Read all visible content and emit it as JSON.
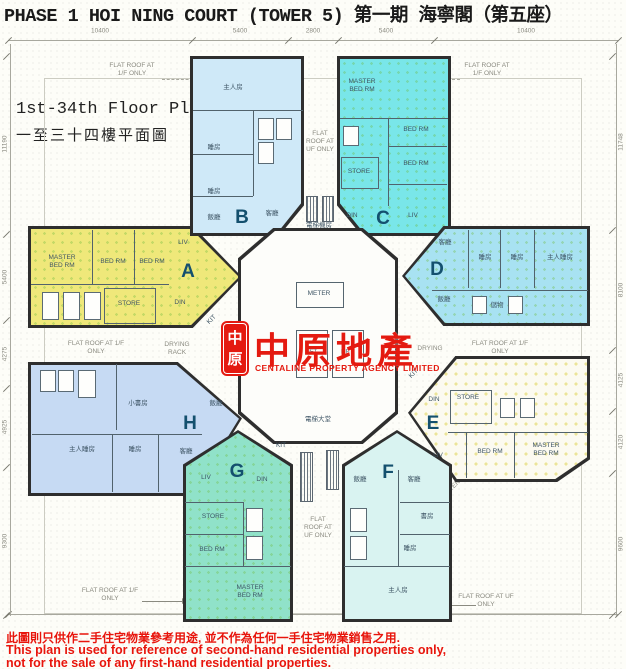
{
  "title": "PHASE 1 HOI NING COURT (TOWER 5) 第一期 海寧閣（第五座）",
  "floor_label": {
    "en": "1st-34th Floor Plan",
    "zh": "一至三十四樓平面圖"
  },
  "logo": {
    "seal_char1": "中",
    "seal_char2": "原",
    "name": "中原地產",
    "subtitle": "CENTALINE PROPERTY AGENCY LIMITED",
    "color": "#e41a10"
  },
  "disclaimer": {
    "zh": "此圖則只供作二手住宅物業參考用途, 並不作為任何一手住宅物業銷售之用.",
    "en1": "This plan is used for reference of second-hand residential properties only,",
    "en2": "not for the sale of any first-hand residential properties."
  },
  "dimensions": {
    "top": [
      "10400",
      "5400",
      "2800",
      "5400",
      "10400"
    ],
    "left": [
      "11190",
      "5400",
      "4275",
      "4925",
      "9300"
    ],
    "right": [
      "11748",
      "8100",
      "4125",
      "4120",
      "9600"
    ]
  },
  "annotations": {
    "flat_roof_1f": "FLAT ROOF AT 1/F ONLY",
    "flat_roof_uf": "FLAT ROOF AT UF ONLY",
    "drying_rack": "DRYING RACK",
    "drying": "DRYING",
    "planter": "PLANTER"
  },
  "core": {
    "meter": "METER",
    "lift": "LIFT",
    "lift_machine": "電梯機房",
    "lift_lobby": "電梯大堂"
  },
  "units": {
    "A": {
      "letter": "A",
      "color": "#efe87a",
      "rooms": [
        "MASTER BED RM",
        "BED RM",
        "BED RM",
        "STORE",
        "LIV",
        "DIN",
        "KIT"
      ]
    },
    "B": {
      "letter": "B",
      "color": "#cfe9f8",
      "rooms": [
        "主人房",
        "睡房",
        "睡房",
        "飯廳",
        "客廳"
      ]
    },
    "C": {
      "letter": "C",
      "color": "#79e6e9",
      "rooms": [
        "MASTER BED RM",
        "BED RM",
        "BED RM",
        "STORE",
        "DIN",
        "LIV"
      ]
    },
    "D": {
      "letter": "D",
      "color": "#a8e2f2",
      "rooms": [
        "客廳",
        "睡房",
        "睡房",
        "主人睡房",
        "飯廳",
        "儲物"
      ]
    },
    "E": {
      "letter": "E",
      "color": "#fcfaf0",
      "rooms": [
        "KIT",
        "STORE",
        "DIN",
        "LIV",
        "BED RM",
        "MASTER BED RM"
      ]
    },
    "F": {
      "letter": "F",
      "color": "#d9f3f1",
      "rooms": [
        "飯廳",
        "客廳",
        "書房",
        "睡房",
        "主人房"
      ]
    },
    "G": {
      "letter": "G",
      "color": "#90e2c9",
      "rooms": [
        "KIT",
        "DIN",
        "LIV",
        "STORE",
        "BED RM",
        "MASTER BED RM"
      ]
    },
    "H": {
      "letter": "H",
      "color": "#c6daf3",
      "rooms": [
        "小書房",
        "飯廳",
        "主人睡房",
        "睡房",
        "客廳"
      ]
    }
  }
}
